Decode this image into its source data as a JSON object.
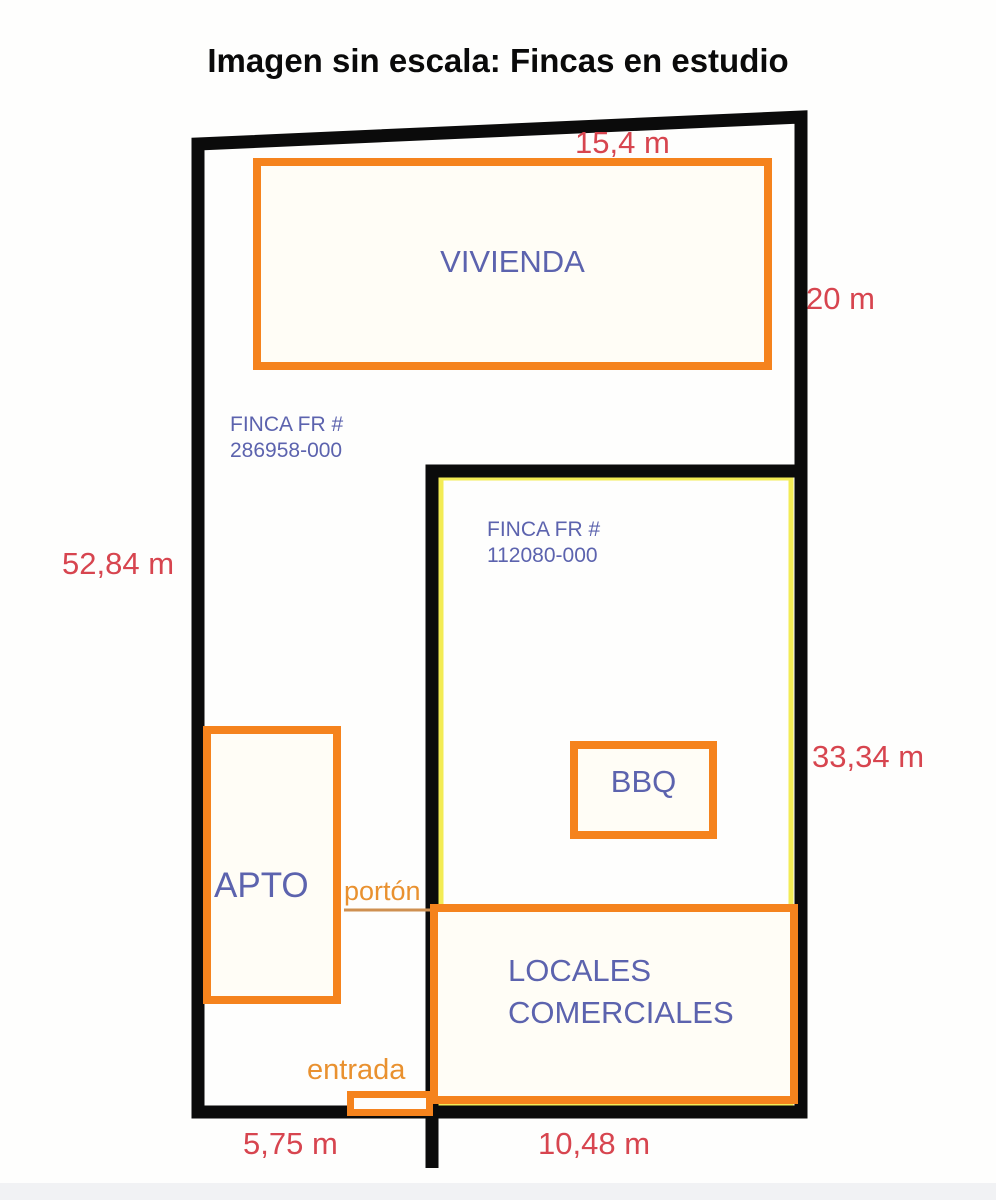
{
  "title": "Imagen sin escala: Fincas en estudio",
  "colors": {
    "boundary_black": "#0b0b0b",
    "building_orange": "#f5831d",
    "label_blue": "#5c63ae",
    "measure_red": "#d7454f",
    "gate_orange": "#e9912f",
    "highlight_yellow": "#f3ec55"
  },
  "parcels": [
    {
      "name": "finca-286958",
      "lines": [
        "FINCA FR #",
        "286958-000"
      ]
    },
    {
      "name": "finca-112080",
      "lines": [
        "FINCA FR #",
        "112080-000"
      ]
    }
  ],
  "buildings": [
    {
      "name": "vivienda",
      "label": "VIVIENDA"
    },
    {
      "name": "apto",
      "label": "APTO"
    },
    {
      "name": "bbq",
      "label": "BBQ"
    },
    {
      "name": "locales-comerciales",
      "lines": [
        "LOCALES",
        "COMERCIALES"
      ]
    }
  ],
  "gates": [
    {
      "name": "porton",
      "label": "portón"
    },
    {
      "name": "entrada",
      "label": "entrada"
    }
  ],
  "measurements": {
    "top": "15,4 m",
    "right_upper": "20 m",
    "left": "52,84 m",
    "right_lower": "33,34 m",
    "bottom_left": "5,75 m",
    "bottom_right": "10,48 m"
  }
}
